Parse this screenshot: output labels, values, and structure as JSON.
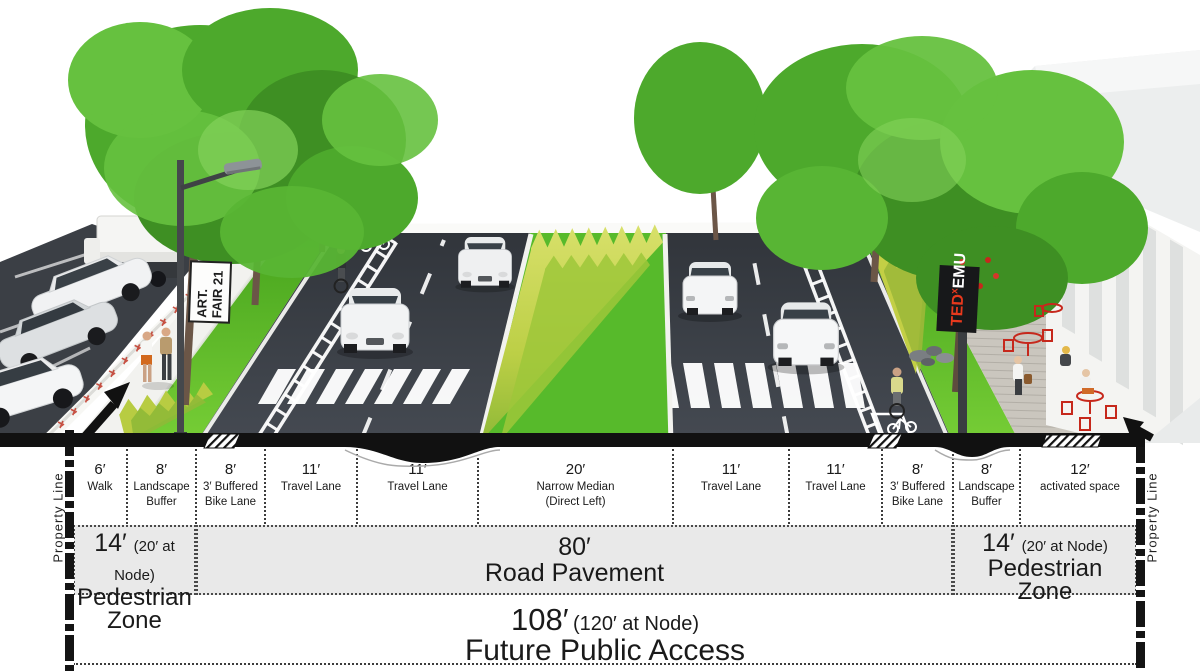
{
  "rendering": {
    "art_fair_sign": {
      "line1": "ART.",
      "line2": "FAIR 21"
    },
    "tedx_banner": {
      "ted": "TED",
      "sup": "x",
      "emu": "EMU"
    },
    "colors": {
      "asphalt": "#3a3e45",
      "lawn_green": "#56bb2b",
      "tall_grass_yellow_green": "#c9d44f",
      "tree_green": "#4da92c",
      "accent_red": "#c6281c",
      "banner_black": "#1a1a1a",
      "banner_red": "#e8391d",
      "sidewalk": "#f2f2ef",
      "deck_wood": "#cac6be",
      "section_cut_black": "#111111"
    }
  },
  "diagram": {
    "property_line": "Property Line",
    "lanes": [
      {
        "dim": "6′",
        "lines": [
          "Walk",
          ""
        ]
      },
      {
        "dim": "8′",
        "lines": [
          "Landscape",
          "Buffer"
        ]
      },
      {
        "dim": "8′",
        "lines": [
          "3′ Buffered",
          "Bike Lane"
        ]
      },
      {
        "dim": "11′",
        "lines": [
          "Travel Lane",
          ""
        ]
      },
      {
        "dim": "11′",
        "lines": [
          "Travel Lane",
          ""
        ]
      },
      {
        "dim": "20′",
        "lines": [
          "Narrow Median",
          "(Direct Left)"
        ]
      },
      {
        "dim": "11′",
        "lines": [
          "Travel Lane",
          ""
        ]
      },
      {
        "dim": "11′",
        "lines": [
          "Travel Lane",
          ""
        ]
      },
      {
        "dim": "8′",
        "lines": [
          "3′ Buffered",
          "Bike Lane"
        ]
      },
      {
        "dim": "8′",
        "lines": [
          "Landscape",
          "Buffer"
        ]
      },
      {
        "dim": "12′",
        "lines": [
          "activated space",
          ""
        ]
      }
    ],
    "zones": {
      "left": {
        "dim": "14′",
        "note": "(20′ at Node)",
        "name1": "Pedestrian",
        "name2": "Zone"
      },
      "center": {
        "dim": "80′",
        "name": "Road Pavement"
      },
      "right": {
        "dim": "14′",
        "note": "(20′ at Node)",
        "name1": "Pedestrian",
        "name2": "Zone"
      }
    },
    "total": {
      "dim": "108′",
      "note": "(120′ at Node)",
      "name": "Future Public Access"
    }
  }
}
